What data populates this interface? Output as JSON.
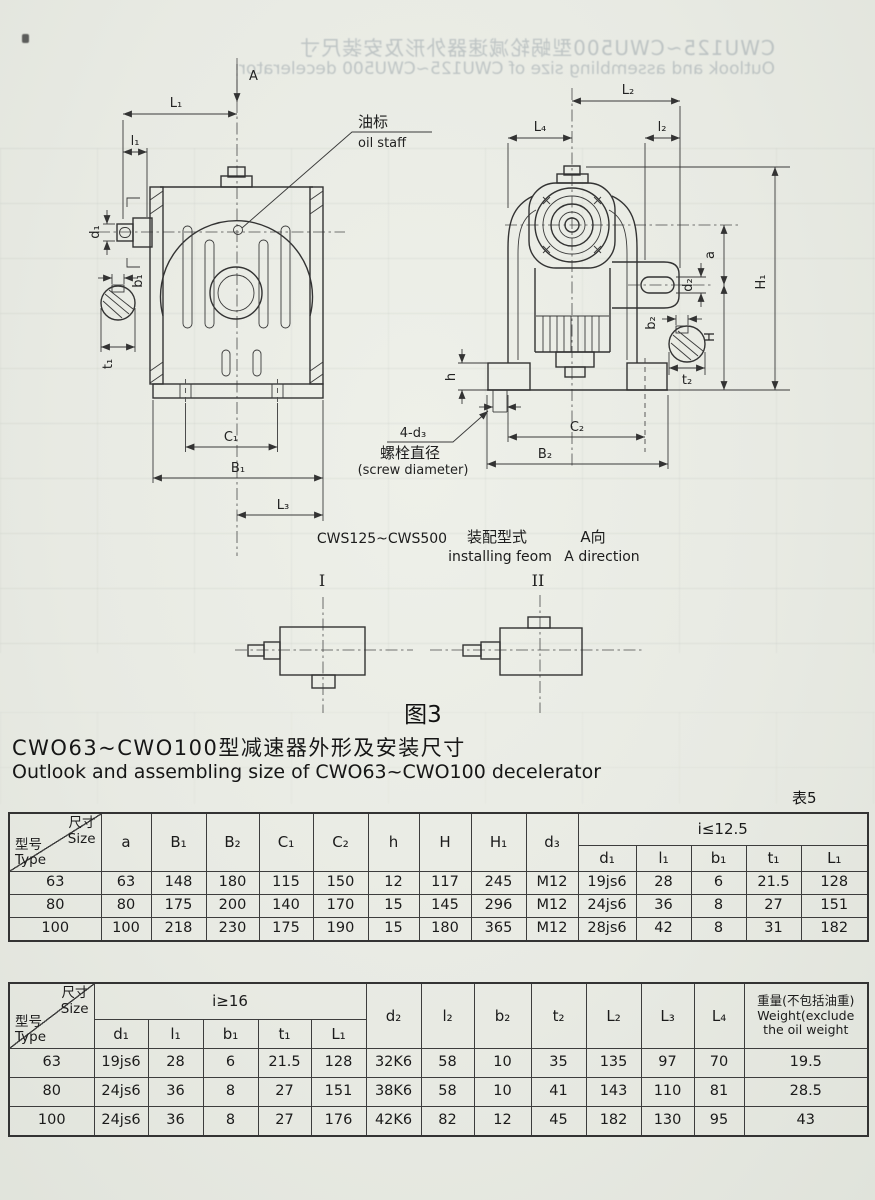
{
  "page": {
    "bleed_title_zh": "CWU125~CWU500型蜗轮减速器外形及安装尺寸",
    "bleed_title_en": "Outlook and assembling size of CWU125~CWU500 decelerator",
    "title_zh": "CWO63~CWO100型减速器外形及安装尺寸",
    "title_en": "Outlook and assembling size of CWO63~CWO100 decelerator",
    "table_no": "表5",
    "figure_caption": "图3"
  },
  "figure": {
    "view_label": "A",
    "dims": {
      "L1": "L₁",
      "l1": "l₁",
      "d1": "d₁",
      "b1": "b₁",
      "t1": "t₁",
      "C1": "C₁",
      "B1": "B₁",
      "L3": "L₃",
      "L2": "L₂",
      "L4": "L₄",
      "l2": "l₂",
      "a": "a",
      "d2": "d₂",
      "b2": "b₂",
      "t2": "t₂",
      "H": "H",
      "H1": "H₁",
      "h": "h",
      "C2": "C₂",
      "B2": "B₂"
    },
    "oil_label_zh": "油标",
    "oil_label_en": "oil staff",
    "screw_label": "4-d₃",
    "screw_zh": "螺栓直径",
    "screw_en": "(screw diameter)",
    "model_range": "CWS125~CWS500",
    "install_zh": "装配型式",
    "install_en": "installing feom",
    "a_dir_zh": "A向",
    "a_dir_en": "A direction",
    "form_1": "I",
    "form_2": "II"
  },
  "table1": {
    "corner": {
      "size_zh": "尺寸",
      "size_en": "Size",
      "type_zh": "型号",
      "type_en": "Type"
    },
    "cols": [
      "a",
      "B₁",
      "B₂",
      "C₁",
      "C₂",
      "h",
      "H",
      "H₁",
      "d₃"
    ],
    "group_label": "i≤12.5",
    "group_cols": [
      "d₁",
      "l₁",
      "b₁",
      "t₁",
      "L₁"
    ],
    "rows": [
      [
        "63",
        "63",
        "148",
        "180",
        "115",
        "150",
        "12",
        "117",
        "245",
        "M12",
        "19js6",
        "28",
        "6",
        "21.5",
        "128"
      ],
      [
        "80",
        "80",
        "175",
        "200",
        "140",
        "170",
        "15",
        "145",
        "296",
        "M12",
        "24js6",
        "36",
        "8",
        "27",
        "151"
      ],
      [
        "100",
        "100",
        "218",
        "230",
        "175",
        "190",
        "15",
        "180",
        "365",
        "M12",
        "28js6",
        "42",
        "8",
        "31",
        "182"
      ]
    ]
  },
  "table2": {
    "corner": {
      "size_zh": "尺寸",
      "size_en": "Size",
      "type_zh": "型号",
      "type_en": "Type"
    },
    "group_label": "i≥16",
    "group_cols": [
      "d₁",
      "l₁",
      "b₁",
      "t₁",
      "L₁"
    ],
    "cols": [
      "d₂",
      "l₂",
      "b₂",
      "t₂",
      "L₂",
      "L₃",
      "L₄"
    ],
    "weight_zh": "重量(不包括油重)",
    "weight_en1": "Weight(exclude",
    "weight_en2": "the oil weight",
    "rows": [
      [
        "63",
        "19js6",
        "28",
        "6",
        "21.5",
        "128",
        "32K6",
        "58",
        "10",
        "35",
        "135",
        "97",
        "70",
        "19.5"
      ],
      [
        "80",
        "24js6",
        "36",
        "8",
        "27",
        "151",
        "38K6",
        "58",
        "10",
        "41",
        "143",
        "110",
        "81",
        "28.5"
      ],
      [
        "100",
        "24js6",
        "36",
        "8",
        "27",
        "176",
        "42K6",
        "82",
        "12",
        "45",
        "182",
        "130",
        "95",
        "43"
      ]
    ]
  }
}
